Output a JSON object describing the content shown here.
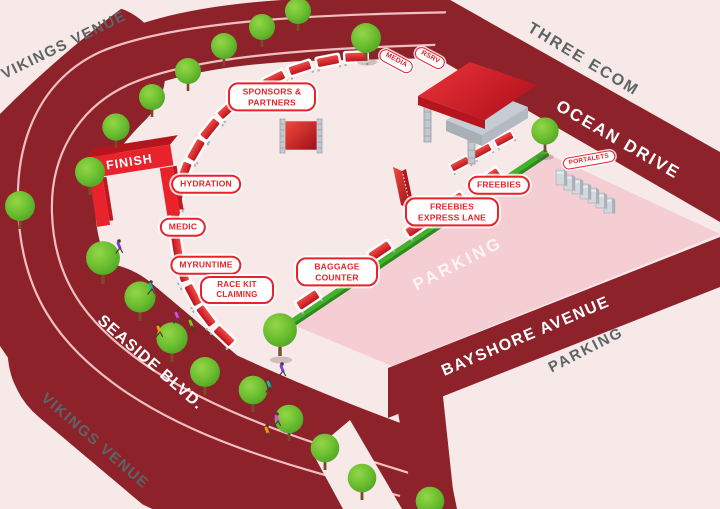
{
  "map": {
    "streets": {
      "vikings_venue_top": "VIKINGS VENUE",
      "three_ecom": "THREE ECOM",
      "ocean_drive": "OCEAN DRIVE",
      "bayshore_avenue": "BAYSHORE AVENUE",
      "seaside_blvd": "SEASIDE BLVD.",
      "vikings_venue_bottom": "VIKINGS VENUE",
      "parking_offsite": "PARKING"
    },
    "areas": {
      "parking_lot": "PARKING"
    },
    "stations": {
      "sponsors_partners": "SPONSORS & PARTNERS",
      "media": "MEDIA",
      "rsrv": "RSRV",
      "hydration": "HYDRATION",
      "medic": "MEDIC",
      "myruntime": "MYRUNTIME",
      "race_kit_claiming": "RACE KIT CLAIMING",
      "baggage_counter": "BAGGAGE COUNTER",
      "freebies": "FREEBIES",
      "freebies_express_lane": "FREEBIES EXPRESS LANE",
      "portalets": "PORTALETS"
    },
    "finish_banner": "FINISH",
    "colors": {
      "road": "#8d222a",
      "background": "#f6e9e8",
      "parking_lot": "#f4ced2",
      "accent_red": "#e8232b",
      "tree_green": "#6cbf30",
      "fence_green": "#48b12f",
      "street_text": "#5d6466"
    }
  }
}
